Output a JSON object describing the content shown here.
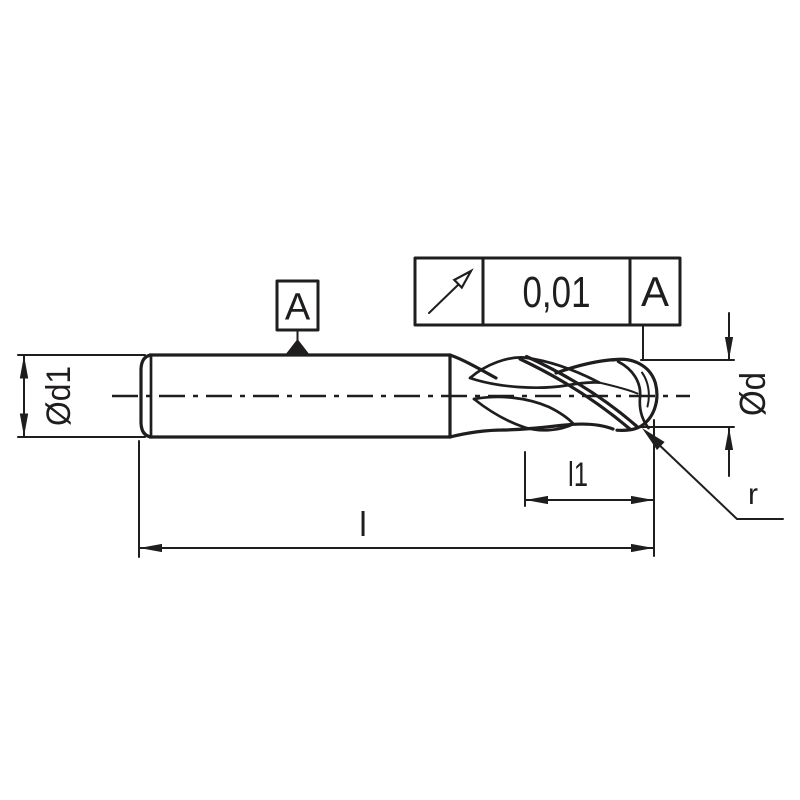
{
  "drawing": {
    "kind": "ball-nose end mill dimension drawing",
    "labels": {
      "shank_diameter": "Ød1",
      "cutting_diameter": "Ød",
      "flute_length": "l1",
      "overall_length": "l",
      "corner_radius": "r"
    },
    "datum": {
      "letter": "A"
    },
    "tolerance_frame": {
      "symbol": "circular-runout",
      "value": "0,01",
      "datum_ref": "A"
    },
    "colors": {
      "line": "#201d1d",
      "background": "#ffffff"
    }
  }
}
